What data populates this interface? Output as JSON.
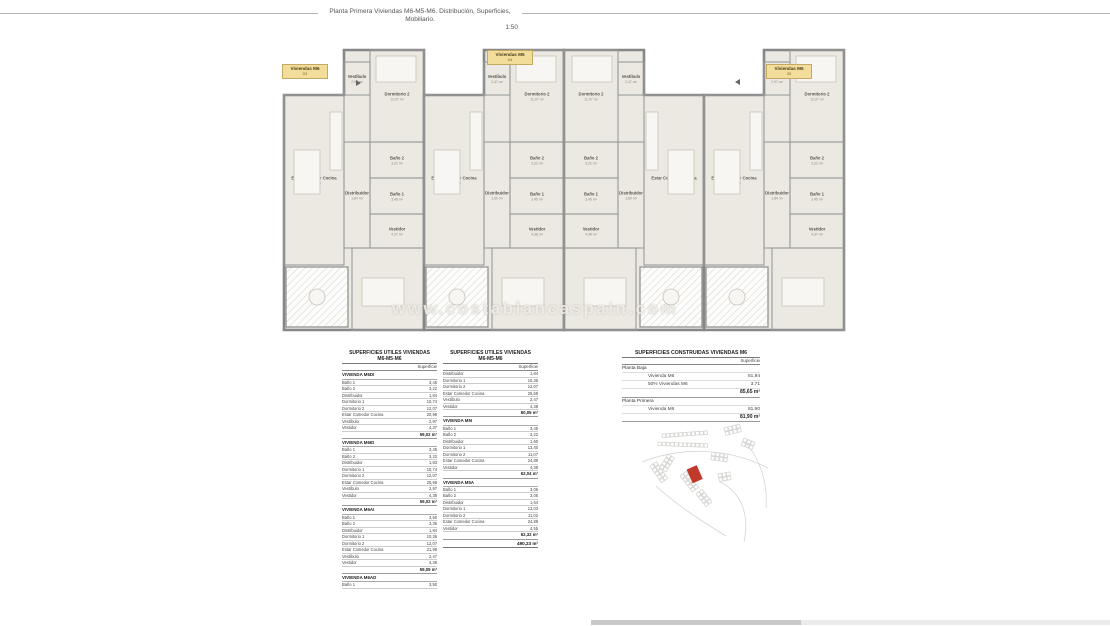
{
  "page": {
    "title": "Planta Primera Viviendas M6-M5-M6. Distribución, Superficies, Mobiliario.",
    "scale": "1:50"
  },
  "watermark": "www.costablancaspain.com",
  "plan": {
    "unit_labels": [
      {
        "name": "Viviendas M6",
        "number": "03"
      },
      {
        "name": "Viviendas M5",
        "number": "04"
      },
      {
        "name": "Viviendas M6",
        "number": "05"
      }
    ],
    "room_sets": {
      "m6": {
        "living": [
          "Estar Comedor Cocina",
          "20,98 m²"
        ],
        "terraza": [
          "Terraza",
          "7,65 m²"
        ],
        "vestibulo": [
          "Vestíbulo",
          "2,97 m²"
        ],
        "dorm2": [
          "Dormitorio 2",
          "12,07 m²"
        ],
        "distribuidor": [
          "Distribuidor",
          "1,84 m²"
        ],
        "bano2": [
          "Baño 2",
          "3,22 m²"
        ],
        "bano1": [
          "Baño 1",
          "3,45 m²"
        ],
        "vestidor": [
          "Vestidor",
          "4,37 m²"
        ],
        "dorm1": [
          "Dormitorio 1",
          "10,74 m²"
        ]
      },
      "m5": {
        "living": [
          "Estar Comedor Cocina",
          "24,89 m²"
        ],
        "terraza": [
          "Terraza",
          "7,65 m²"
        ],
        "vestibulo": [
          "Vestíbulo",
          "2,47 m²"
        ],
        "dorm2": [
          "Dormitorio 2",
          "11,07 m²"
        ],
        "distribuidor": [
          "Distribuidor",
          "1,60 m²"
        ],
        "bano2": [
          "Baño 2",
          "3,22 m²"
        ],
        "bano1": [
          "Baño 1",
          "3,45 m²"
        ],
        "vestidor": [
          "Vestidor",
          "4,38 m²"
        ],
        "dorm1": [
          "Dormitorio 1",
          "13,40 m²"
        ]
      }
    }
  },
  "tables": {
    "utiles_left": {
      "title1": "SUPERFICIES UTILES VIVIENDAS",
      "title2": "M6-M5-M6",
      "col_header": "Superficie",
      "sections": [
        {
          "header": "VIVIENDA M6DI",
          "rows": [
            [
              "Baño 1",
              "3,45"
            ],
            [
              "Baño 2",
              "3,22"
            ],
            [
              "Distribuidor",
              "1,84"
            ],
            [
              "Dormitorio 1",
              "10,74"
            ],
            [
              "Dormitorio 2",
              "12,07"
            ],
            [
              "Estar Comedor Cocina",
              "20,98"
            ],
            [
              "Vestíbulo",
              "2,97"
            ],
            [
              "Vestidor",
              "4,37"
            ]
          ],
          "subtotal": "59,02 m²"
        },
        {
          "header": "VIVIENDA M6ID",
          "rows": [
            [
              "Baño 1",
              "3,45"
            ],
            [
              "Baño 2",
              "3,22"
            ],
            [
              "Distribuidor",
              "1,83"
            ],
            [
              "Dormitorio 1",
              "10,74"
            ],
            [
              "Dormitorio 2",
              "12,07"
            ],
            [
              "Estar Comedor Cocina",
              "20,98"
            ],
            [
              "Vestíbulo",
              "2,97"
            ],
            [
              "Vestidor",
              "4,38"
            ]
          ],
          "subtotal": "59,02 m²"
        },
        {
          "header": "VIVIENDA M6AI",
          "rows": [
            [
              "Baño 1",
              "3,50"
            ],
            [
              "Baño 2",
              "3,35"
            ],
            [
              "Distribuidor",
              "1,84"
            ],
            [
              "Dormitorio 1",
              "10,36"
            ],
            [
              "Dormitorio 2",
              "12,07"
            ],
            [
              "Estar Comedor Cocina",
              "21,98"
            ],
            [
              "Vestíbulo",
              "2,47"
            ],
            [
              "Vestidor",
              "4,38"
            ]
          ],
          "subtotal": "59,09 m²"
        },
        {
          "header": "VIVIENDA M6AD",
          "rows": [
            [
              "Baño 1",
              "3,50"
            ]
          ],
          "subtotal": null
        }
      ],
      "grand_total": null
    },
    "utiles_right": {
      "title1": "SUPERFICIES UTILES VIVIENDAS",
      "title2": "M6-M5-M6",
      "col_header": "Superficie",
      "sections": [
        {
          "header": null,
          "rows": [
            [
              "Distribuidor",
              "1,84"
            ],
            [
              "Dormitorio 1",
              "10,36"
            ],
            [
              "Dormitorio 2",
              "12,07"
            ],
            [
              "Estar Comedor Cocina",
              "25,69"
            ],
            [
              "Vestíbulo",
              "2,47"
            ],
            [
              "Vestidor",
              "4,38"
            ]
          ],
          "subtotal": "60,05 m²"
        },
        {
          "header": "VIVIENDA M5I",
          "rows": [
            [
              "Baño 1",
              "3,45"
            ],
            [
              "Baño 2",
              "3,22"
            ],
            [
              "Distribuidor",
              "1,60"
            ],
            [
              "Dormitorio 1",
              "13,40"
            ],
            [
              "Dormitorio 2",
              "11,07"
            ],
            [
              "Estar Comedor Cocina",
              "24,89"
            ],
            [
              "Vestidor",
              "4,38"
            ]
          ],
          "subtotal": "62,04 m²"
        },
        {
          "header": "VIVIENDA M5A",
          "rows": [
            [
              "Baño 1",
              "3,06"
            ],
            [
              "Baño 2",
              "3,05"
            ],
            [
              "Distribuidor",
              "1,64"
            ],
            [
              "Dormitorio 1",
              "13,03"
            ],
            [
              "Dormitorio 2",
              "11,02"
            ],
            [
              "Estar Comedor Cocina",
              "24,89"
            ],
            [
              "Vestidor",
              "4,55"
            ]
          ],
          "subtotal": "62,32 m²"
        }
      ],
      "grand_total": "490,23 m²"
    },
    "construidas": {
      "title": "SUPERFICIES CONSTRUIDAS VIVIENDAS M6",
      "col_header": "Superficie",
      "groups": [
        {
          "header": "Planta Baja",
          "rows": [
            [
              "Vivienda M6",
              "81,94"
            ],
            [
              "50% Viviendas M6",
              "3,71"
            ]
          ],
          "subtotal": "85,65 m²"
        },
        {
          "header": "Planta Primera",
          "rows": [
            [
              "Vivienda M6",
              "81,90"
            ]
          ],
          "subtotal": "81,90 m²"
        }
      ]
    }
  },
  "site_map": {
    "marker_color": "#c0392b"
  }
}
